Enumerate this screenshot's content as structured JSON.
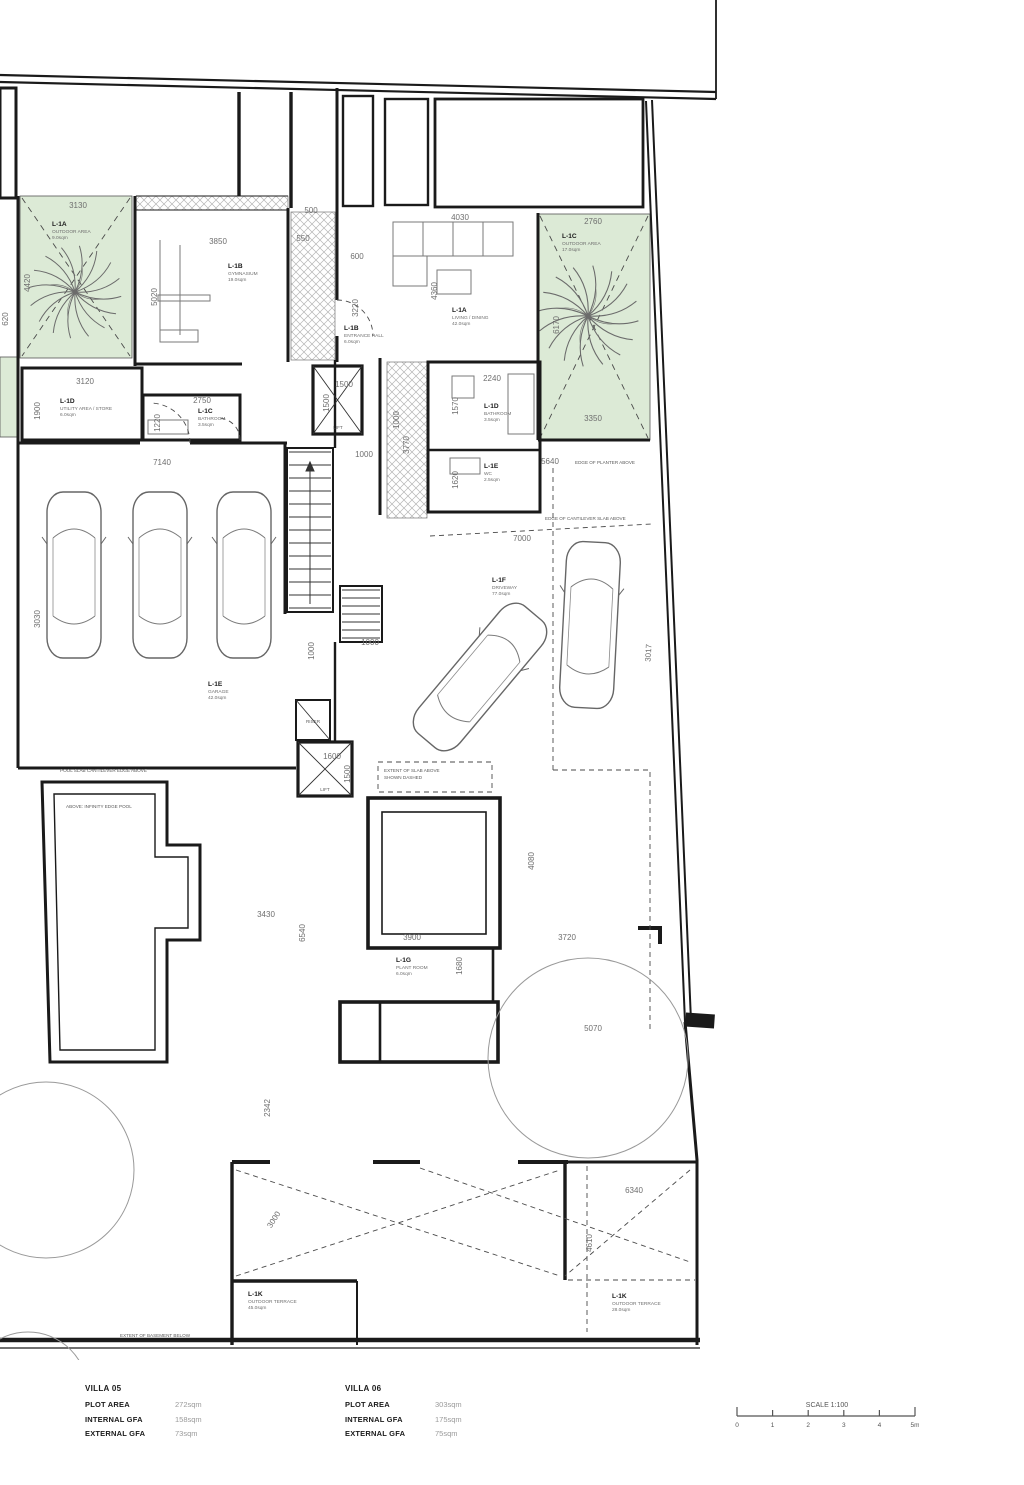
{
  "colors": {
    "wall": "#1a1a1a",
    "green": "#dcead6",
    "dim_text": "#6e6e6e",
    "dashed": "#4a4a4a",
    "hatch": "#b5b5b5"
  },
  "dims": {
    "green1_w": "3130",
    "green1_h": "4420",
    "gym_w": "3850",
    "gym_h": "5020",
    "d500": "500",
    "d550": "550",
    "store_w": "3120",
    "store_h": "1900",
    "bath1_w": "2750",
    "bath1_h": "1220",
    "corridor": "7140",
    "garage_h": "3030",
    "lift1_w": "1500",
    "lift1_h": "1500",
    "r1000a": "1000",
    "d3770": "3770",
    "d1000b": "1000",
    "r1000c": "1000",
    "d1000d": "1000",
    "lift2_w": "1600",
    "lift2_h": "1500",
    "pool_w": "3430",
    "pool_h": "6540",
    "d2342": "2342",
    "d3000": "3000",
    "sofa_w": "4030",
    "green2_w": "2760",
    "d600": "600",
    "d3220": "3220",
    "d4360": "4360",
    "green2_h": "6170",
    "green2_b": "3350",
    "bath2_w": "2240",
    "bath2_h": "1570",
    "d5640": "5640",
    "wc_h": "1620",
    "d7000": "7000",
    "d4080": "4080",
    "plant_w": "3900",
    "plant_h": "1680",
    "d3720": "3720",
    "d5070": "5070",
    "d6340": "6340",
    "d4610": "4610",
    "left_cut": "620",
    "d3017": "3017"
  },
  "rooms": {
    "v5_outdoor": {
      "code": "L-1A",
      "name": "OUTDOOR AREA",
      "area": "9.0sqm"
    },
    "v5_gym": {
      "code": "L-1B",
      "name": "GYMNASIUM",
      "area": "19.0sqm"
    },
    "v5_bath": {
      "code": "L-1C",
      "name": "BATHROOM",
      "area": "3.5sqm"
    },
    "v5_store": {
      "code": "L-1D",
      "name": "UTILITY AREA / STORE",
      "area": "6.0sqm"
    },
    "v5_garage": {
      "code": "L-1E",
      "name": "GARAGE",
      "area": "42.0sqm"
    },
    "v5_plant": {
      "code": "L-1G",
      "name": "PLANT ROOM",
      "area": "6.0sqm"
    },
    "v5_terrace": {
      "code": "L-1K",
      "name": "OUTDOOR TERRACE",
      "area": "45.0sqm"
    },
    "v6_living": {
      "code": "L-1A",
      "name": "LIVING / DINING",
      "area": "42.0sqm"
    },
    "v6_entry": {
      "code": "L-1B",
      "name": "ENTRANCE HALL",
      "area": "6.0sqm"
    },
    "v6_outdoor": {
      "code": "L-1C",
      "name": "OUTDOOR AREA",
      "area": "17.0sqm"
    },
    "v6_bath": {
      "code": "L-1D",
      "name": "BATHROOM",
      "area": "3.5sqm"
    },
    "v6_wc": {
      "code": "L-1E",
      "name": "WC",
      "area": "2.5sqm"
    },
    "v6_drive": {
      "code": "L-1F",
      "name": "DRIVEWAY",
      "area": "77.0sqm"
    },
    "v6_terrace": {
      "code": "L-1K",
      "name": "OUTDOOR TERRACE",
      "area": "28.0sqm"
    }
  },
  "annotations": {
    "pool_edge": "POOL SLAB CANTILEVER EDGE ABOVE",
    "infinity": "ABOVE: INFINITY EDGE POOL",
    "slab1": "EXTENT OF SLAB ABOVE",
    "slab2": "SHOWN DASHED",
    "canopy": "EDGE OF CANTILEVER SLAB ABOVE",
    "planter": "EDGE OF PLANTER ABOVE",
    "basement": "EXTENT OF BASEMENT BELOW",
    "lift1": "LIFT",
    "lift2": "LIFT",
    "riser": "RISER"
  },
  "tables": {
    "villa05": {
      "title": "VILLA 05",
      "rows": [
        {
          "k": "PLOT AREA",
          "v": "272sqm"
        },
        {
          "k": "INTERNAL GFA",
          "v": "158sqm"
        },
        {
          "k": "EXTERNAL GFA",
          "v": "73sqm"
        }
      ]
    },
    "villa06": {
      "title": "VILLA 06",
      "rows": [
        {
          "k": "PLOT AREA",
          "v": "303sqm"
        },
        {
          "k": "INTERNAL GFA",
          "v": "175sqm"
        },
        {
          "k": "EXTERNAL GFA",
          "v": "75sqm"
        }
      ]
    }
  },
  "scalebar": {
    "label": "SCALE 1:100",
    "ticks": [
      "0",
      "1",
      "2",
      "3",
      "4",
      "5m"
    ]
  }
}
